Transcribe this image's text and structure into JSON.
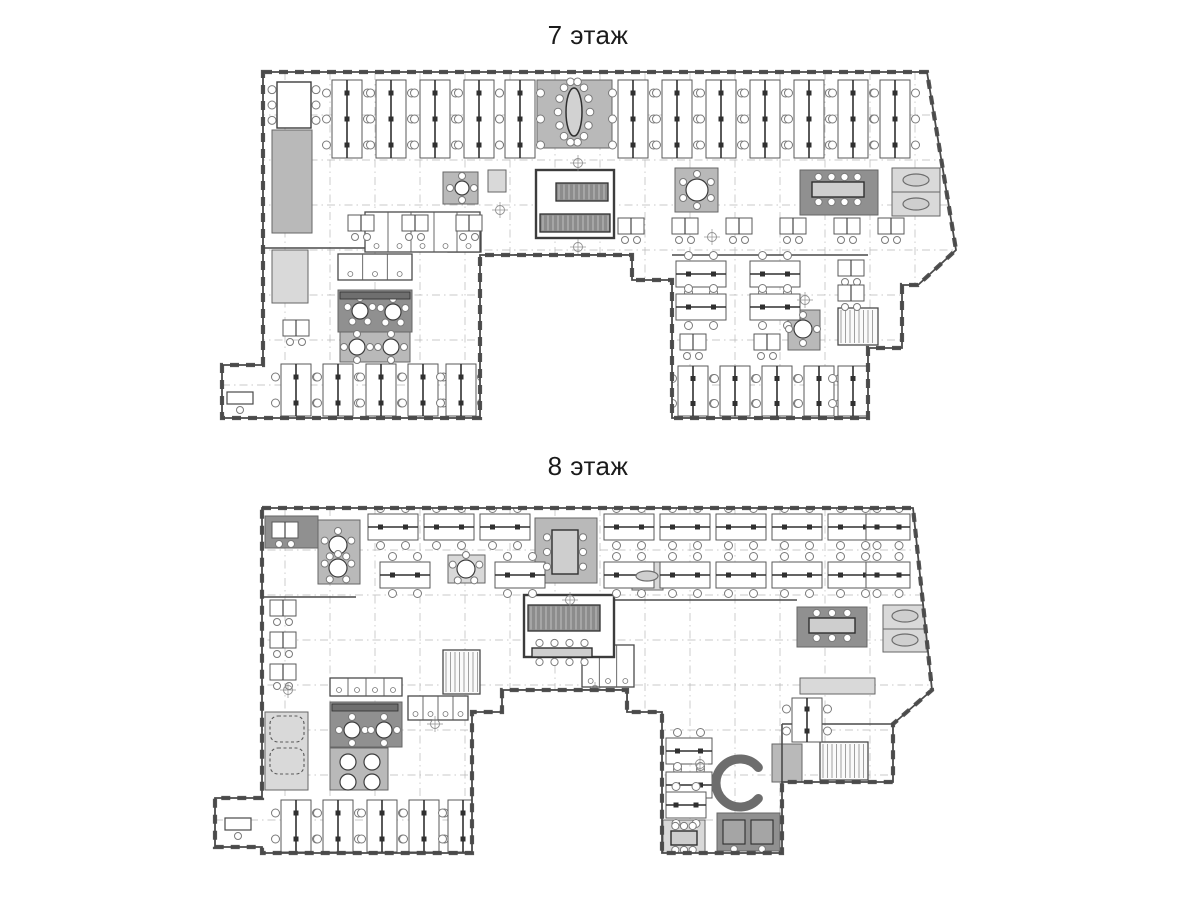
{
  "sheet": {
    "background": "#ffffff"
  },
  "palette": {
    "wall": "#4a4a4a",
    "line": "#5a5a5a",
    "grid": "#b7b7b7",
    "dark": "#909090",
    "mid": "#b9b9b9",
    "light": "#d9d9d9",
    "paper": "#ffffff"
  },
  "floors": [
    {
      "name": "floor-7",
      "title": "7 этаж",
      "outline": [
        [
          263,
          72
        ],
        [
          927,
          72
        ],
        [
          956,
          250
        ],
        [
          918,
          285
        ],
        [
          902,
          285
        ],
        [
          902,
          348
        ],
        [
          868,
          348
        ],
        [
          868,
          418
        ],
        [
          672,
          418
        ],
        [
          672,
          280
        ],
        [
          632,
          280
        ],
        [
          632,
          255
        ],
        [
          480,
          255
        ],
        [
          480,
          418
        ],
        [
          222,
          418
        ],
        [
          222,
          365
        ],
        [
          263,
          365
        ]
      ],
      "grid": {
        "vx": [
          285,
          330,
          375,
          420,
          465,
          510,
          555,
          600,
          645,
          690,
          735,
          780,
          825,
          870,
          915
        ],
        "y1": 72,
        "y2": 418,
        "hy": [
          115,
          160,
          205,
          250,
          295,
          340,
          385
        ],
        "x1": 222,
        "x2": 956
      },
      "rooms": [
        [
          272,
          130,
          40,
          103,
          "mid"
        ],
        [
          272,
          250,
          36,
          53,
          "light"
        ],
        [
          338,
          290,
          74,
          42,
          "dark"
        ],
        [
          340,
          332,
          70,
          30,
          "mid"
        ],
        [
          443,
          172,
          35,
          32,
          "mid"
        ],
        [
          488,
          170,
          18,
          22,
          "light"
        ],
        [
          537,
          80,
          75,
          68,
          "mid"
        ],
        [
          675,
          168,
          43,
          44,
          "mid"
        ],
        [
          838,
          170,
          16,
          22,
          "light"
        ],
        [
          800,
          170,
          78,
          45,
          "dark"
        ],
        [
          892,
          168,
          48,
          24,
          "light"
        ],
        [
          892,
          192,
          48,
          24,
          "light"
        ],
        [
          788,
          310,
          32,
          40,
          "mid"
        ]
      ],
      "walls": [
        [
          263,
          248,
          480,
          248
        ],
        [
          672,
          255,
          868,
          255
        ]
      ],
      "stairs": [
        [
          838,
          308,
          40,
          37
        ],
        [
          448,
          222,
          33,
          30
        ]
      ],
      "wc": [
        [
          365,
          212,
          115,
          40,
          5
        ],
        [
          338,
          254,
          74,
          26,
          3
        ]
      ],
      "core": {
        "room": [
          536,
          170,
          78,
          68
        ],
        "bands": [
          [
            556,
            183,
            52,
            18
          ],
          [
            540,
            214,
            70,
            18
          ]
        ]
      },
      "cells": [
        515,
        255,
        112,
        23,
        4
      ],
      "bench_v": [
        [
          332,
          80
        ],
        [
          376,
          80
        ],
        [
          420,
          80
        ],
        [
          464,
          80
        ],
        [
          505,
          80
        ],
        [
          618,
          80
        ],
        [
          662,
          80
        ],
        [
          706,
          80
        ],
        [
          750,
          80
        ],
        [
          794,
          80
        ],
        [
          838,
          80
        ],
        [
          880,
          80
        ],
        [
          281,
          364,
          52
        ],
        [
          323,
          364,
          52
        ],
        [
          366,
          364,
          52
        ],
        [
          408,
          364,
          52
        ],
        [
          446,
          364,
          52
        ],
        [
          678,
          366,
          50
        ],
        [
          720,
          366,
          50
        ],
        [
          762,
          366,
          50
        ],
        [
          804,
          366,
          50
        ],
        [
          838,
          366,
          50
        ]
      ],
      "bench_h": [
        [
          676,
          261
        ],
        [
          750,
          261
        ],
        [
          676,
          294
        ],
        [
          750,
          294
        ]
      ],
      "desk2": [
        [
          348,
          215
        ],
        [
          402,
          215
        ],
        [
          456,
          215
        ],
        [
          618,
          218
        ],
        [
          672,
          218
        ],
        [
          726,
          218
        ],
        [
          780,
          218
        ],
        [
          834,
          218
        ],
        [
          878,
          218
        ],
        [
          680,
          334
        ],
        [
          754,
          334
        ],
        [
          838,
          260
        ],
        [
          838,
          285
        ],
        [
          283,
          320
        ]
      ],
      "table6": [
        [
          277,
          82,
          34,
          46
        ]
      ],
      "table_r": [
        [
          697,
          190,
          11,
          6
        ],
        [
          803,
          329,
          9,
          4
        ],
        [
          357,
          347,
          8,
          4
        ],
        [
          391,
          347,
          8,
          4
        ],
        [
          360,
          311,
          8,
          5
        ],
        [
          393,
          312,
          8,
          5
        ],
        [
          462,
          188,
          7,
          4
        ]
      ],
      "table_oval": [
        [
          574,
          112,
          8,
          24
        ]
      ],
      "table_rect": [
        [
          812,
          182,
          52,
          15
        ]
      ],
      "sofa": [
        [
          916,
          180,
          13,
          6
        ],
        [
          916,
          204,
          13,
          6
        ]
      ],
      "counter": [
        [
          340,
          292,
          70,
          7
        ]
      ],
      "recep": [
        [
          227,
          392,
          26,
          12
        ]
      ],
      "markers": [
        [
          578,
          163
        ],
        [
          578,
          247
        ],
        [
          500,
          210
        ],
        [
          712,
          237
        ],
        [
          805,
          300
        ]
      ]
    },
    {
      "name": "floor-8",
      "title": "8 этаж",
      "outline": [
        [
          262,
          508
        ],
        [
          913,
          508
        ],
        [
          932,
          690
        ],
        [
          893,
          724
        ],
        [
          893,
          782
        ],
        [
          782,
          782
        ],
        [
          782,
          853
        ],
        [
          662,
          853
        ],
        [
          662,
          712
        ],
        [
          627,
          712
        ],
        [
          627,
          690
        ],
        [
          502,
          690
        ],
        [
          502,
          712
        ],
        [
          472,
          712
        ],
        [
          472,
          853
        ],
        [
          262,
          853
        ],
        [
          262,
          847
        ],
        [
          215,
          847
        ],
        [
          215,
          798
        ],
        [
          262,
          798
        ]
      ],
      "grid": {
        "vx": [
          285,
          330,
          375,
          420,
          465,
          510,
          555,
          600,
          645,
          690,
          735,
          780,
          825,
          870
        ],
        "y1": 508,
        "y2": 853,
        "hy": [
          550,
          595,
          640,
          685,
          730,
          775,
          820
        ],
        "x1": 215,
        "x2": 932
      },
      "rooms": [
        [
          265,
          516,
          53,
          32,
          "dark"
        ],
        [
          318,
          520,
          42,
          64,
          "mid"
        ],
        [
          448,
          555,
          37,
          28,
          "light"
        ],
        [
          535,
          518,
          62,
          65,
          "mid"
        ],
        [
          632,
          562,
          31,
          28,
          "light"
        ],
        [
          797,
          607,
          70,
          40,
          "dark"
        ],
        [
          883,
          605,
          44,
          24,
          "light"
        ],
        [
          883,
          629,
          44,
          23,
          "light"
        ],
        [
          330,
          702,
          72,
          45,
          "dark"
        ],
        [
          330,
          748,
          58,
          42,
          "mid"
        ],
        [
          265,
          712,
          43,
          78,
          "light"
        ],
        [
          663,
          820,
          42,
          33,
          "light"
        ],
        [
          717,
          813,
          63,
          38,
          "dark"
        ],
        [
          800,
          678,
          75,
          16,
          "light"
        ],
        [
          772,
          744,
          30,
          38,
          "mid"
        ]
      ],
      "walls": [
        [
          262,
          597,
          356,
          597
        ],
        [
          782,
          724,
          893,
          724
        ],
        [
          782,
          724,
          782,
          782
        ],
        [
          614,
          600,
          797,
          600
        ]
      ],
      "stairs": [
        [
          443,
          650,
          37,
          44
        ],
        [
          820,
          742,
          48,
          38
        ]
      ],
      "wc": [
        [
          330,
          678,
          72,
          18,
          4
        ],
        [
          582,
          645,
          52,
          42,
          3
        ],
        [
          408,
          696,
          60,
          24,
          4
        ]
      ],
      "core": {
        "room": [
          524,
          595,
          90,
          62
        ],
        "bands": [
          [
            528,
            605,
            72,
            26
          ]
        ]
      },
      "cells": [
        510,
        690,
        117,
        22,
        4
      ],
      "bench_v": [
        [
          281,
          800,
          52
        ],
        [
          323,
          800,
          52
        ],
        [
          367,
          800,
          52
        ],
        [
          409,
          800,
          52
        ],
        [
          448,
          800,
          52
        ],
        [
          792,
          698,
          44
        ]
      ],
      "bench_h": [
        [
          368,
          514
        ],
        [
          424,
          514
        ],
        [
          480,
          514
        ],
        [
          604,
          514
        ],
        [
          660,
          514
        ],
        [
          716,
          514
        ],
        [
          772,
          514
        ],
        [
          828,
          514
        ],
        [
          866,
          514,
          44
        ],
        [
          380,
          562
        ],
        [
          495,
          562
        ],
        [
          604,
          562
        ],
        [
          660,
          562
        ],
        [
          716,
          562
        ],
        [
          772,
          562
        ],
        [
          828,
          562
        ],
        [
          866,
          562,
          44
        ],
        [
          666,
          738,
          46
        ],
        [
          666,
          772,
          46
        ],
        [
          666,
          792,
          40
        ]
      ],
      "desk2": [
        [
          270,
          600
        ],
        [
          270,
          632
        ],
        [
          270,
          664
        ],
        [
          272,
          522
        ]
      ],
      "table_r": [
        [
          466,
          569,
          9,
          5
        ],
        [
          338,
          545,
          9,
          5
        ],
        [
          338,
          568,
          9,
          5
        ],
        [
          352,
          730,
          8,
          4
        ],
        [
          384,
          730,
          8,
          4
        ],
        [
          348,
          762,
          8,
          0
        ],
        [
          372,
          762,
          8,
          0
        ],
        [
          348,
          782,
          8,
          0
        ],
        [
          372,
          782,
          8,
          0
        ]
      ],
      "table_rect": [
        [
          552,
          530,
          26,
          44
        ],
        [
          809,
          618,
          46,
          15
        ],
        [
          532,
          648,
          60,
          9
        ],
        [
          671,
          831,
          26,
          14
        ]
      ],
      "sofa": [
        [
          647,
          576,
          11,
          5
        ],
        [
          905,
          616,
          13,
          6
        ],
        [
          905,
          640,
          13,
          6
        ]
      ],
      "csofa": [
        [
          740,
          783,
          24
        ]
      ],
      "dashed_rect": [
        [
          270,
          716,
          34,
          26
        ],
        [
          270,
          748,
          34,
          26
        ]
      ],
      "counter": [
        [
          332,
          704,
          66,
          7
        ]
      ],
      "bench_dark": [
        [
          723,
          820,
          22,
          24
        ],
        [
          751,
          820,
          22,
          24
        ]
      ],
      "recep": [
        [
          225,
          818,
          26,
          12
        ]
      ],
      "markers": [
        [
          570,
          600
        ],
        [
          595,
          690
        ],
        [
          435,
          724
        ],
        [
          700,
          764
        ],
        [
          288,
          690
        ]
      ]
    }
  ]
}
